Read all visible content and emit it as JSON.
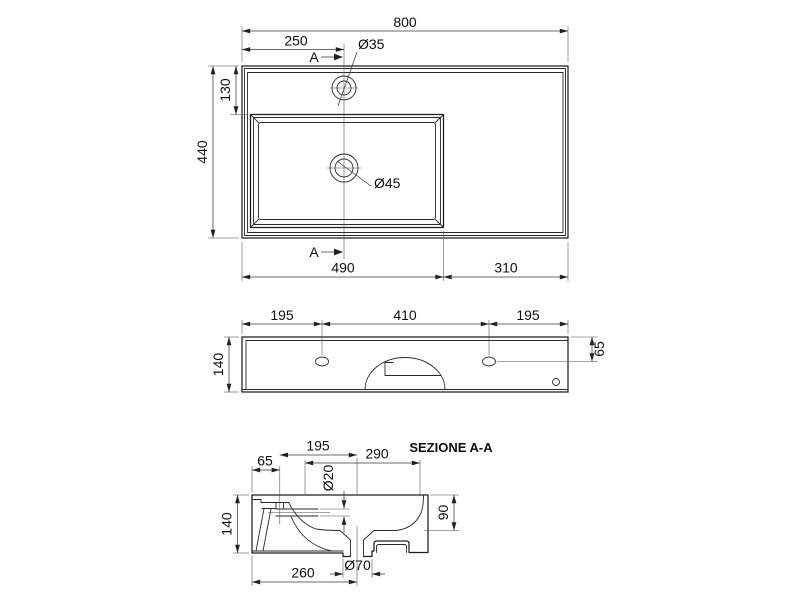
{
  "plan": {
    "width": "800",
    "tap_offset": "250",
    "tap_hole": "Ø35",
    "tap_depth": "130",
    "depth": "440",
    "basin_len": "490",
    "deck_len": "310",
    "drain_hole": "Ø45",
    "marker": "A"
  },
  "front": {
    "hole_left": "195",
    "hole_span": "410",
    "hole_right": "195",
    "height": "140",
    "hole_top": "65"
  },
  "section": {
    "title": "SEZIONE A-A",
    "tap_to_drain": "195",
    "bowl_open": "290",
    "tap_back": "65",
    "inlet": "Ø20",
    "height": "140",
    "bowl_depth": "90",
    "drain_back": "260",
    "drain_boss": "Ø70"
  }
}
